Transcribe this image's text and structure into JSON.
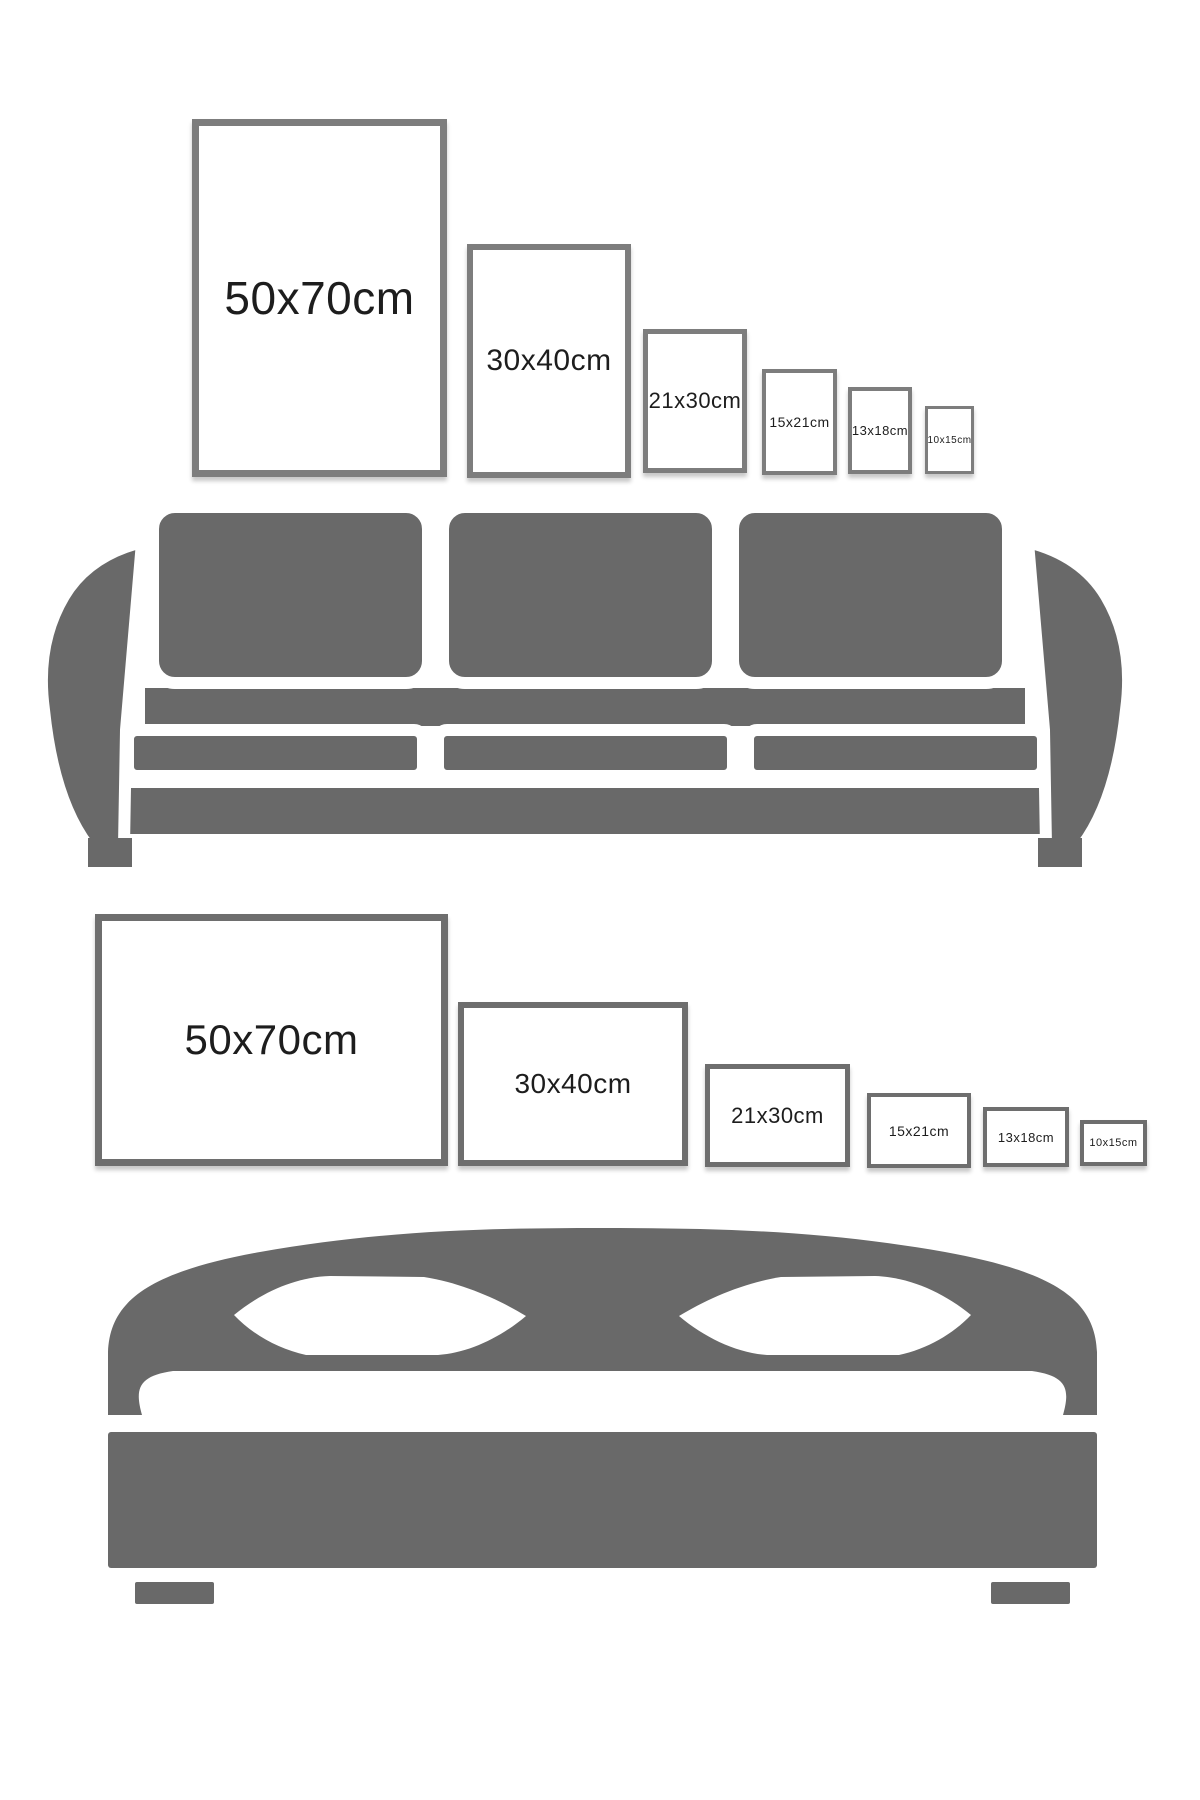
{
  "canvas": {
    "width": 1200,
    "height": 1800,
    "background": "#ffffff"
  },
  "colors": {
    "furniture": "#696969",
    "label": "#1d1d1d",
    "separator": "#ffffff"
  },
  "rows": [
    {
      "name": "portrait-size-row-above-sofa",
      "orientation": "portrait",
      "border_color": "#7d7d7d",
      "frames": [
        {
          "label": "50x70cm",
          "x": 192,
          "y": 119,
          "w": 255,
          "h": 358,
          "border": 7,
          "font": 46
        },
        {
          "label": "30x40cm",
          "x": 467,
          "y": 244,
          "w": 164,
          "h": 234,
          "border": 6,
          "font": 30
        },
        {
          "label": "21x30cm",
          "x": 643,
          "y": 329,
          "w": 104,
          "h": 144,
          "border": 5,
          "font": 22
        },
        {
          "label": "15x21cm",
          "x": 762,
          "y": 369,
          "w": 75,
          "h": 106,
          "border": 4,
          "font": 14
        },
        {
          "label": "13x18cm",
          "x": 848,
          "y": 387,
          "w": 64,
          "h": 87,
          "border": 4,
          "font": 13
        },
        {
          "label": "10x15cm",
          "x": 925,
          "y": 406,
          "w": 49,
          "h": 68,
          "border": 3,
          "font": 10
        }
      ]
    },
    {
      "name": "landscape-size-row-above-bed",
      "orientation": "landscape",
      "border_color": "#6e6e6e",
      "frames": [
        {
          "label": "50x70cm",
          "x": 95,
          "y": 914,
          "w": 353,
          "h": 252,
          "border": 7,
          "font": 42
        },
        {
          "label": "30x40cm",
          "x": 458,
          "y": 1002,
          "w": 230,
          "h": 164,
          "border": 6,
          "font": 28
        },
        {
          "label": "21x30cm",
          "x": 705,
          "y": 1064,
          "w": 145,
          "h": 103,
          "border": 5,
          "font": 22
        },
        {
          "label": "15x21cm",
          "x": 867,
          "y": 1093,
          "w": 104,
          "h": 75,
          "border": 4,
          "font": 14
        },
        {
          "label": "13x18cm",
          "x": 983,
          "y": 1107,
          "w": 86,
          "h": 60,
          "border": 4,
          "font": 13
        },
        {
          "label": "10x15cm",
          "x": 1080,
          "y": 1120,
          "w": 67,
          "h": 46,
          "border": 4,
          "font": 11
        }
      ]
    }
  ],
  "illustrations": [
    {
      "name": "three-seat-sofa"
    },
    {
      "name": "double-bed"
    }
  ]
}
